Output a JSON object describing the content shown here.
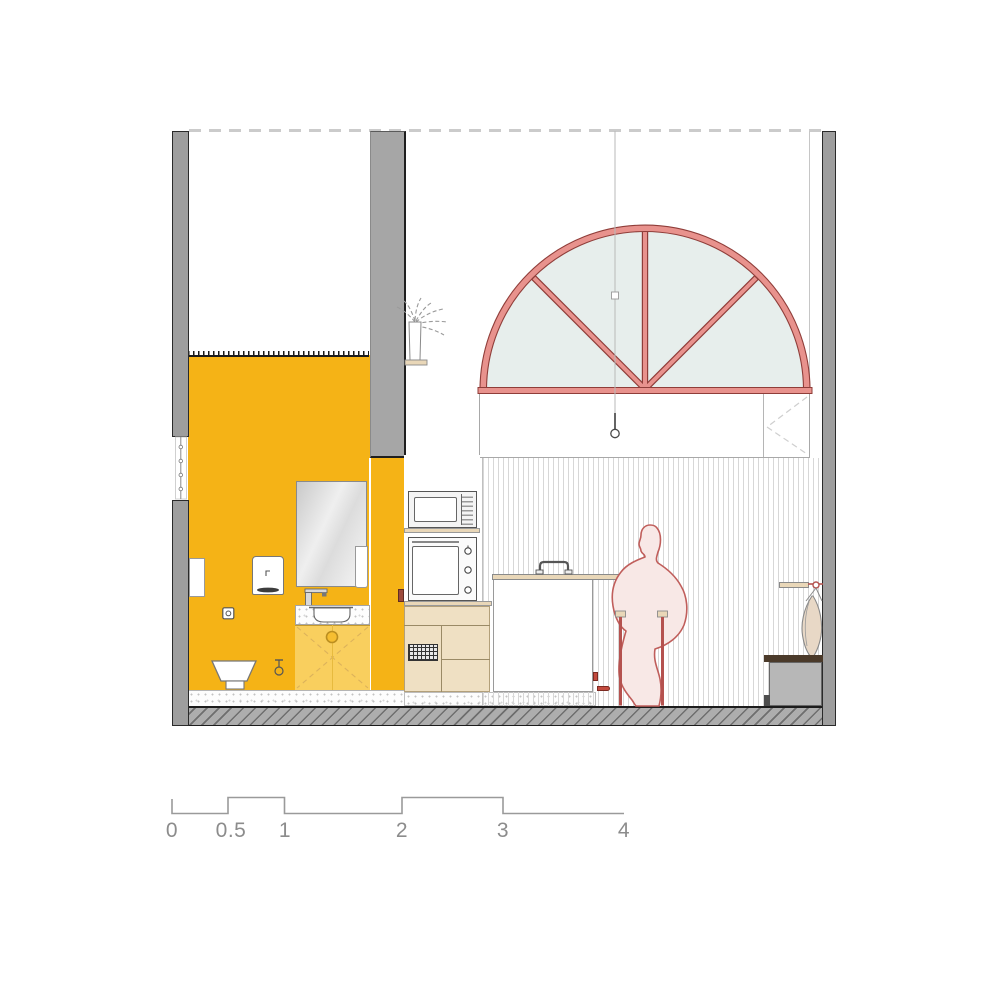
{
  "drawing": {
    "type": "architectural-cross-section",
    "rooms": [
      "bathroom",
      "kitchen",
      "living-space"
    ],
    "objects": [
      "exterior-wall-left",
      "exterior-wall-right",
      "partition-wall",
      "ceiling-dashed-line",
      "arched-window",
      "pendant-lamp",
      "plant-on-shelf",
      "mirror",
      "towel",
      "hand-dryer",
      "wall-niche",
      "power-outlet",
      "sink-faucet",
      "sink-bowl",
      "vanity-cabinet",
      "toilet",
      "water-valve",
      "sliding-door-handle",
      "microwave",
      "oven",
      "kitchen-counter",
      "base-cabinet",
      "vent-grille",
      "kitchen-island",
      "pot-lid-handle",
      "person-figure",
      "bar-stool",
      "wall-shelf-right",
      "hanging-vase",
      "bench",
      "floor-slab",
      "scale-bar"
    ],
    "colors": {
      "accent_yellow": "#F5B316",
      "vanity_yellow": "#F9CF5E",
      "window_frame_salmon": "#E8928D",
      "window_frame_dark": "#8F3D39",
      "window_glass": "#E7EEEC",
      "figure_fill": "#F8E8E6",
      "figure_outline": "#C05E5B",
      "wall_gray": "#9E9E9E",
      "floor_gray": "#ADADAD",
      "wood_tan": "#E9D7B8",
      "bench_gray": "#B7B7B7",
      "bench_top_brown": "#4B3A2A",
      "scale_gray": "#8C8C8C"
    },
    "scalebar": {
      "labels": [
        "0",
        "0.5",
        "1",
        "2",
        "3",
        "4"
      ]
    }
  }
}
